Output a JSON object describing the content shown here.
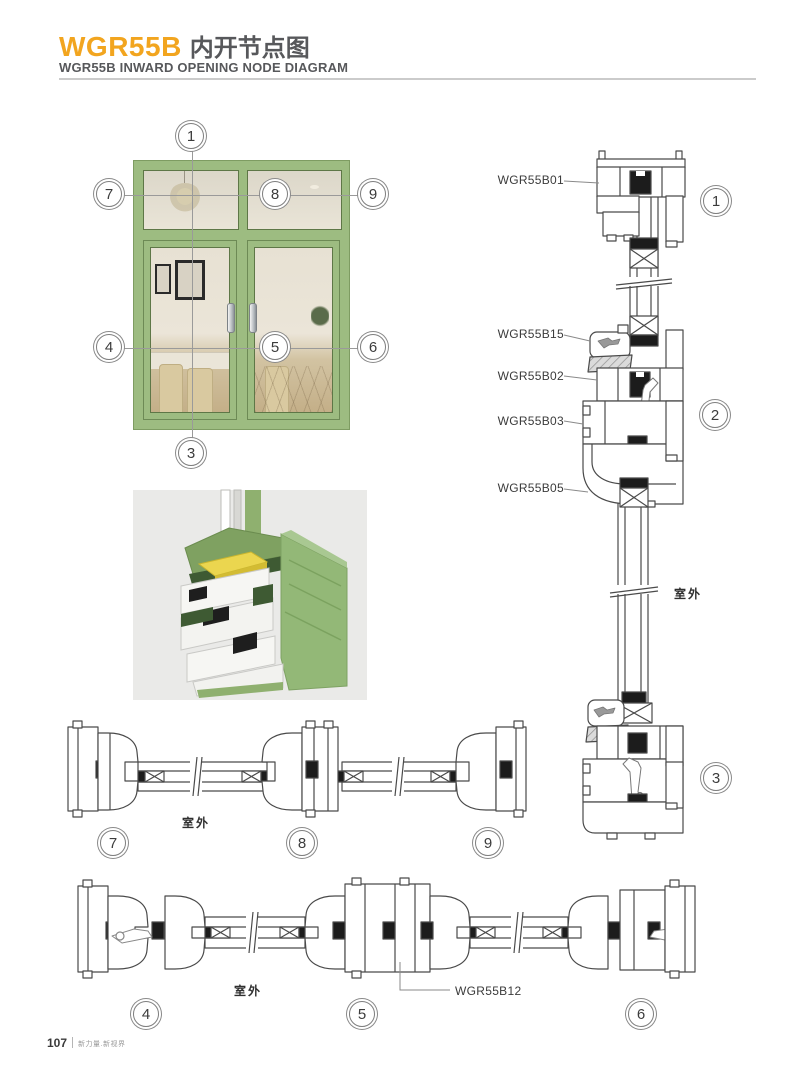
{
  "header": {
    "product_code": "WGR55B",
    "title_cn": "内开节点图",
    "subtitle": "WGR55B INWARD OPENING NODE DIAGRAM"
  },
  "window": {
    "callouts": {
      "c1": "1",
      "c3": "3",
      "c4": "4",
      "c5": "5",
      "c6": "6",
      "c7": "7",
      "c8": "8",
      "c9": "9"
    }
  },
  "vertical_section": {
    "parts": [
      {
        "label": "WGR55B01"
      },
      {
        "label": "WGR55B15"
      },
      {
        "label": "WGR55B02"
      },
      {
        "label": "WGR55B03"
      },
      {
        "label": "WGR55B05"
      }
    ],
    "outdoor_label": "室外",
    "callouts": {
      "c1": "1",
      "c2": "2",
      "c3": "3"
    }
  },
  "top_horizontal_section": {
    "outdoor_label": "室外",
    "callouts": {
      "c7": "7",
      "c8": "8",
      "c9": "9"
    }
  },
  "bottom_horizontal_section": {
    "outdoor_label": "室外",
    "part_label": "WGR55B12",
    "callouts": {
      "c4": "4",
      "c5": "5",
      "c6": "6"
    }
  },
  "footer": {
    "page_number": "107",
    "tagline": "新力量.新视界"
  },
  "colors": {
    "accent": "#F2A51F",
    "heading": "#57585B",
    "frame_green": "#9DBC81",
    "drawing_line": "#4A4A4A",
    "gasket_black": "#1C1C1C"
  }
}
